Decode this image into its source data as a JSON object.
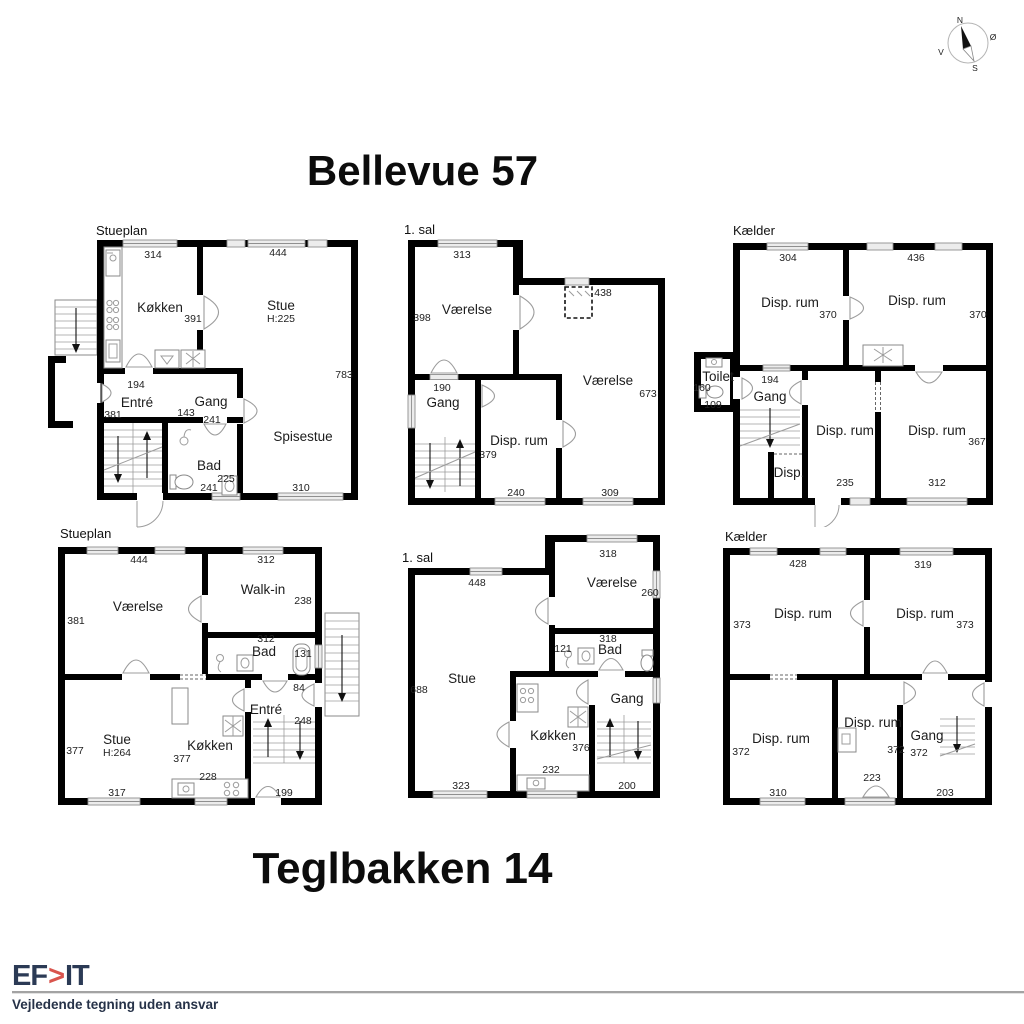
{
  "titles": {
    "top": "Bellevue 57",
    "bottom": "Teglbakken 14"
  },
  "compass": {
    "north": "N",
    "east": "Ø",
    "south": "S",
    "west": "V"
  },
  "footer": {
    "logo_left": "EF",
    "logo_chevron": ">",
    "logo_right": "IT",
    "disclaimer": "Vejledende tegning uden ansvar",
    "logo_color": "#2b3a55",
    "accent_color": "#d9544d"
  },
  "plans": {
    "a": {
      "floor": "Stueplan",
      "rooms": {
        "kokken": "Køkken",
        "stue": "Stue",
        "stue_h": "H:225",
        "entre": "Entré",
        "gang": "Gang",
        "bad": "Bad",
        "spisestue": "Spisestue"
      },
      "dims": {
        "d314": "314",
        "d444": "444",
        "d391": "391",
        "d783": "783",
        "d194": "194",
        "d381": "381",
        "d143": "143",
        "d241a": "241",
        "d225": "225",
        "d241b": "241",
        "d310": "310"
      }
    },
    "b": {
      "floor": "1. sal",
      "rooms": {
        "vaerelse1": "Værelse",
        "vaerelse2": "Værelse",
        "gang": "Gang",
        "disp": "Disp. rum"
      },
      "dims": {
        "d313": "313",
        "d398": "398",
        "d438": "438",
        "d673": "673",
        "d190": "190",
        "d379": "379",
        "d240": "240",
        "d309": "309"
      }
    },
    "c": {
      "floor": "Kælder",
      "rooms": {
        "disp1": "Disp. rum",
        "disp2": "Disp. rum",
        "toilet": "Toilet",
        "gang": "Gang",
        "disp3": "Disp. rum",
        "disp4": "Disp. rum",
        "disp5": "Disp."
      },
      "dims": {
        "d304": "304",
        "d436": "436",
        "d370a": "370",
        "d370b": "370",
        "d160": "160",
        "d109": "109",
        "d194": "194",
        "d235": "235",
        "d312": "312",
        "d367": "367"
      }
    },
    "d": {
      "floor": "Stueplan",
      "rooms": {
        "vaerelse": "Værelse",
        "walkin": "Walk-in",
        "bad": "Bad",
        "entre": "Entré",
        "stue": "Stue",
        "stue_h": "H:264",
        "kokken": "Køkken"
      },
      "dims": {
        "d444": "444",
        "d312a": "312",
        "d381": "381",
        "d238": "238",
        "d312b": "312",
        "d131": "131",
        "d84": "84",
        "d248": "248",
        "d377a": "377",
        "d377b": "377",
        "d228": "228",
        "d317": "317",
        "d199": "199"
      }
    },
    "e": {
      "floor": "1. sal",
      "rooms": {
        "stue": "Stue",
        "vaerelse": "Værelse",
        "bad": "Bad",
        "gang": "Gang",
        "kokken": "Køkken"
      },
      "dims": {
        "d448": "448",
        "d318a": "318",
        "d260": "260",
        "d318b": "318",
        "d121": "121",
        "d688": "688",
        "d376": "376",
        "d232": "232",
        "d323": "323",
        "d200": "200"
      }
    },
    "f": {
      "floor": "Kælder",
      "rooms": {
        "disp1": "Disp. rum",
        "disp2": "Disp. rum",
        "disp3": "Disp. rum",
        "disp4": "Disp. rum",
        "gang": "Gang"
      },
      "dims": {
        "d428": "428",
        "d319": "319",
        "d373a": "373",
        "d373b": "373",
        "d372a": "372",
        "d310": "310",
        "d372b": "372",
        "d223": "223",
        "d372c": "372",
        "d203": "203"
      }
    }
  }
}
